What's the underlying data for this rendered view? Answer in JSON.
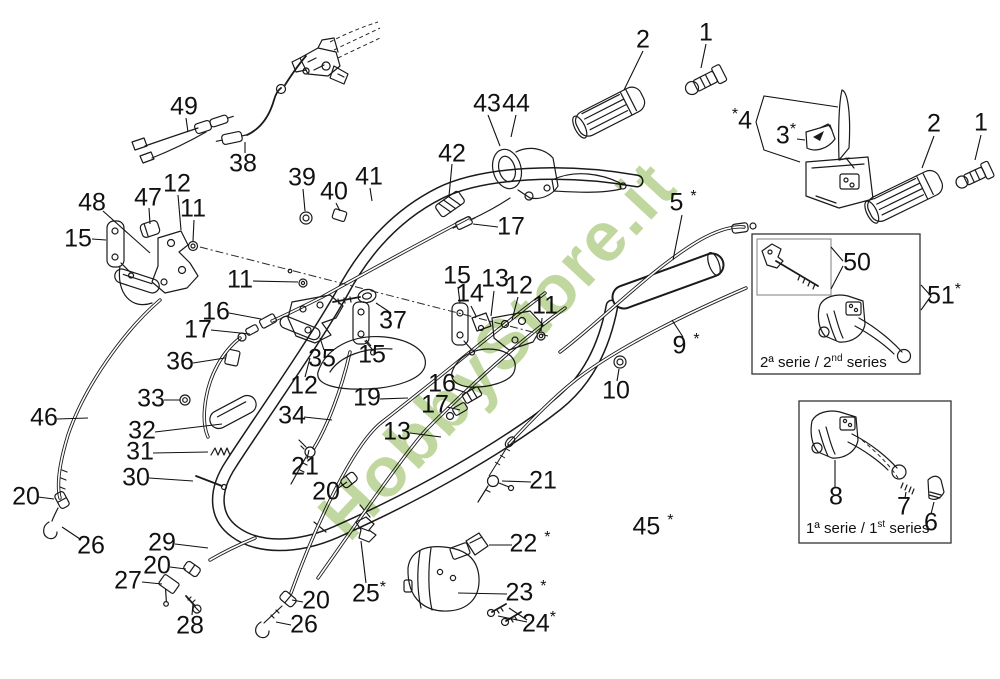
{
  "page": {
    "background": "#ffffff",
    "ink": "#1a1a1a",
    "watermark_green": "#8db752"
  },
  "watermark": {
    "text": "HobbyStore.it"
  },
  "insets": {
    "second": {
      "pre": "2ª serie / 2",
      "sup": "nd",
      "post": " series"
    },
    "first": {
      "pre": "1ª serie / 1",
      "sup": "st",
      "post": " series"
    }
  },
  "part_labels": [
    {
      "id": "49",
      "text": "49",
      "x": 184,
      "y": 107
    },
    {
      "id": "38",
      "text": "38",
      "x": 243,
      "y": 164
    },
    {
      "id": "48",
      "text": "48",
      "x": 92,
      "y": 203
    },
    {
      "id": "47",
      "text": "47",
      "x": 148,
      "y": 198
    },
    {
      "id": "12a",
      "text": "12",
      "x": 177,
      "y": 184
    },
    {
      "id": "11a",
      "text": "11",
      "x": 193,
      "y": 209
    },
    {
      "id": "15a",
      "text": "15",
      "x": 78,
      "y": 239
    },
    {
      "id": "39",
      "text": "39",
      "x": 302,
      "y": 178
    },
    {
      "id": "40",
      "text": "40",
      "x": 334,
      "y": 192
    },
    {
      "id": "41",
      "text": "41",
      "x": 369,
      "y": 177
    },
    {
      "id": "42",
      "text": "42",
      "x": 452,
      "y": 154
    },
    {
      "id": "43",
      "text": "43",
      "x": 487,
      "y": 104
    },
    {
      "id": "44",
      "text": "44",
      "x": 516,
      "y": 104
    },
    {
      "id": "17a",
      "text": "17",
      "x": 511,
      "y": 227
    },
    {
      "id": "2a",
      "text": "2",
      "x": 643,
      "y": 40
    },
    {
      "id": "1a",
      "text": "1",
      "x": 706,
      "y": 33
    },
    {
      "id": "4",
      "text": "*4",
      "x": 742,
      "y": 121
    },
    {
      "id": "3",
      "text": "3*",
      "x": 786,
      "y": 136
    },
    {
      "id": "2b",
      "text": "2",
      "x": 934,
      "y": 124
    },
    {
      "id": "1b",
      "text": "1",
      "x": 981,
      "y": 123
    },
    {
      "id": "5",
      "text": "5 *",
      "x": 683,
      "y": 203
    },
    {
      "id": "11b",
      "text": "11",
      "x": 240,
      "y": 280
    },
    {
      "id": "16a",
      "text": "16",
      "x": 216,
      "y": 312
    },
    {
      "id": "17b",
      "text": "17",
      "x": 198,
      "y": 330
    },
    {
      "id": "36",
      "text": "36",
      "x": 180,
      "y": 362
    },
    {
      "id": "33",
      "text": "33",
      "x": 151,
      "y": 399
    },
    {
      "id": "32",
      "text": "32",
      "x": 142,
      "y": 431
    },
    {
      "id": "31",
      "text": "31",
      "x": 140,
      "y": 452
    },
    {
      "id": "30",
      "text": "30",
      "x": 136,
      "y": 478
    },
    {
      "id": "46",
      "text": "46",
      "x": 44,
      "y": 418
    },
    {
      "id": "20a",
      "text": "20",
      "x": 26,
      "y": 497
    },
    {
      "id": "26a",
      "text": "26",
      "x": 91,
      "y": 546
    },
    {
      "id": "29",
      "text": "29",
      "x": 162,
      "y": 543
    },
    {
      "id": "20b",
      "text": "20",
      "x": 157,
      "y": 566
    },
    {
      "id": "27",
      "text": "27",
      "x": 128,
      "y": 581
    },
    {
      "id": "28",
      "text": "28",
      "x": 190,
      "y": 626
    },
    {
      "id": "20c",
      "text": "20",
      "x": 316,
      "y": 601
    },
    {
      "id": "26b",
      "text": "26",
      "x": 304,
      "y": 625
    },
    {
      "id": "25",
      "text": "25*",
      "x": 369,
      "y": 594
    },
    {
      "id": "35",
      "text": "35",
      "x": 322,
      "y": 359
    },
    {
      "id": "12b",
      "text": "12",
      "x": 304,
      "y": 386
    },
    {
      "id": "34",
      "text": "34",
      "x": 292,
      "y": 416
    },
    {
      "id": "21a",
      "text": "21",
      "x": 305,
      "y": 467
    },
    {
      "id": "20d",
      "text": "20",
      "x": 326,
      "y": 492
    },
    {
      "id": "37",
      "text": "37",
      "x": 393,
      "y": 321
    },
    {
      "id": "15b",
      "text": "15",
      "x": 372,
      "y": 355
    },
    {
      "id": "19",
      "text": "19",
      "x": 367,
      "y": 398
    },
    {
      "id": "15c",
      "text": "15",
      "x": 457,
      "y": 276
    },
    {
      "id": "14",
      "text": "14",
      "x": 470,
      "y": 294
    },
    {
      "id": "13a",
      "text": "13",
      "x": 495,
      "y": 279
    },
    {
      "id": "12c",
      "text": "12",
      "x": 519,
      "y": 286
    },
    {
      "id": "11c",
      "text": "11",
      "x": 545,
      "y": 306
    },
    {
      "id": "16b",
      "text": "16",
      "x": 442,
      "y": 384
    },
    {
      "id": "17c",
      "text": "17",
      "x": 435,
      "y": 405
    },
    {
      "id": "13b",
      "text": "13",
      "x": 397,
      "y": 432
    },
    {
      "id": "9",
      "text": "9 *",
      "x": 686,
      "y": 346
    },
    {
      "id": "10",
      "text": "10",
      "x": 616,
      "y": 391
    },
    {
      "id": "21b",
      "text": "21",
      "x": 543,
      "y": 481
    },
    {
      "id": "22",
      "text": "22 *",
      "x": 530,
      "y": 544
    },
    {
      "id": "23",
      "text": "23 *",
      "x": 526,
      "y": 593
    },
    {
      "id": "24",
      "text": "24*",
      "x": 539,
      "y": 624
    },
    {
      "id": "45",
      "text": "45 *",
      "x": 653,
      "y": 527
    },
    {
      "id": "50",
      "text": "50",
      "x": 857,
      "y": 263
    },
    {
      "id": "51",
      "text": "51*",
      "x": 944,
      "y": 296
    },
    {
      "id": "8",
      "text": "8",
      "x": 836,
      "y": 497
    },
    {
      "id": "7",
      "text": "7",
      "x": 904,
      "y": 507
    },
    {
      "id": "6",
      "text": "6",
      "x": 931,
      "y": 523
    }
  ]
}
